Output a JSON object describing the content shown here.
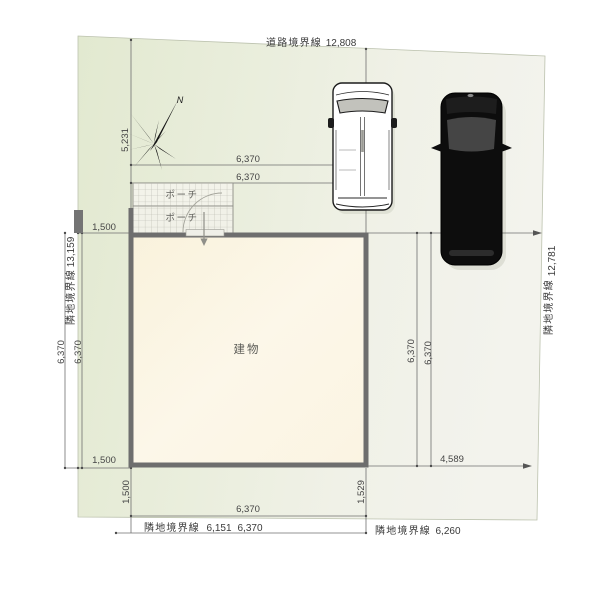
{
  "site": {
    "boundaries": {
      "road": {
        "label": "道路境界線",
        "length": "12,808"
      },
      "left": {
        "label": "隣地境界線",
        "length": "13,159"
      },
      "right": {
        "label": "隣地境界線",
        "length": "12,781"
      },
      "bottom_left": {
        "label": "隣地境界線",
        "length": "6,151"
      },
      "bottom_right": {
        "label": "隣地境界線",
        "length": "6,260"
      }
    },
    "building": {
      "label": "建物"
    },
    "porch": {
      "label_upper": "ポーチ",
      "label_lower": "ポーチ"
    },
    "compass": {
      "north": "N"
    },
    "dimensions": {
      "front_offset": "5,231",
      "building_width": "6,370",
      "building_depth": "6,370",
      "left_setback": "1,500",
      "rear_setback": "1,500",
      "bottom_right_setback": "1,529",
      "driveway": "4,589"
    },
    "colors": {
      "lot_green": "#e5ebd6",
      "lot_light": "#f3f3ec",
      "building_fill": "#faf3df",
      "wall": "#6e6e6e",
      "car_black": "#0d0d0d",
      "car_white": "#ffffff",
      "dim_line": "#6f6f6f"
    }
  }
}
